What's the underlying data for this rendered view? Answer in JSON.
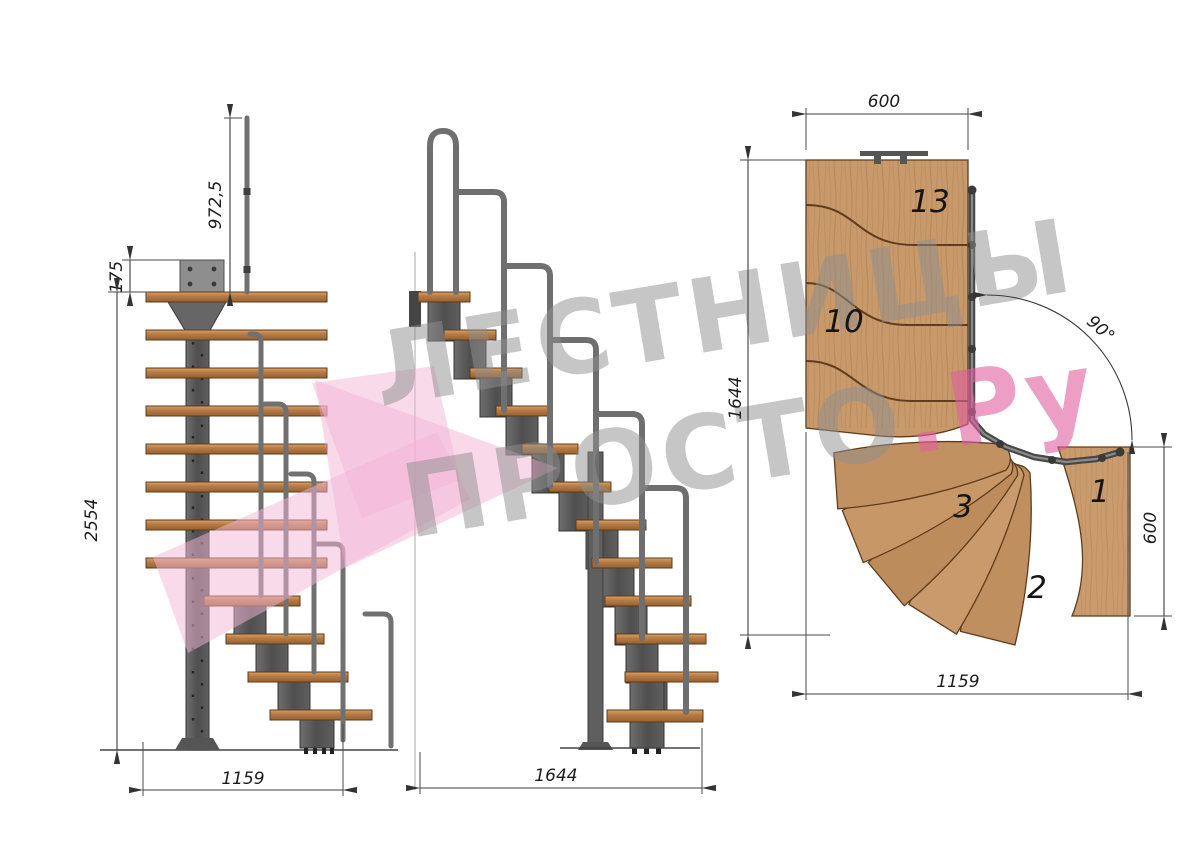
{
  "views": {
    "front": {
      "dims": {
        "rail_height": "972,5",
        "plate_offset": "175",
        "total_height": "2554",
        "width": "1159"
      }
    },
    "side": {
      "dims": {
        "length": "1644"
      }
    },
    "plan": {
      "dims": {
        "top_width": "600",
        "left_length": "1644",
        "turn_angle": "90°",
        "right_depth": "600",
        "bottom_length": "1159"
      },
      "step_labels": {
        "s13": "13",
        "s10": "10",
        "s3": "3",
        "s2": "2",
        "s1": "1"
      }
    }
  },
  "watermark": {
    "line1": "ЛЕСТНИЦЫ",
    "line2": "ПРОСТО",
    "suffix": ".Ру"
  },
  "colors": {
    "wood_plan": "#c89a6b",
    "wood_side": "#b87c45",
    "metal": "#565656",
    "rail": "#707070",
    "logo_pink": "#f3b5d7",
    "watermark_pink": "#e25f9f",
    "watermark_gray": "#8f8f8f",
    "dimension": "#3c3c3c"
  }
}
